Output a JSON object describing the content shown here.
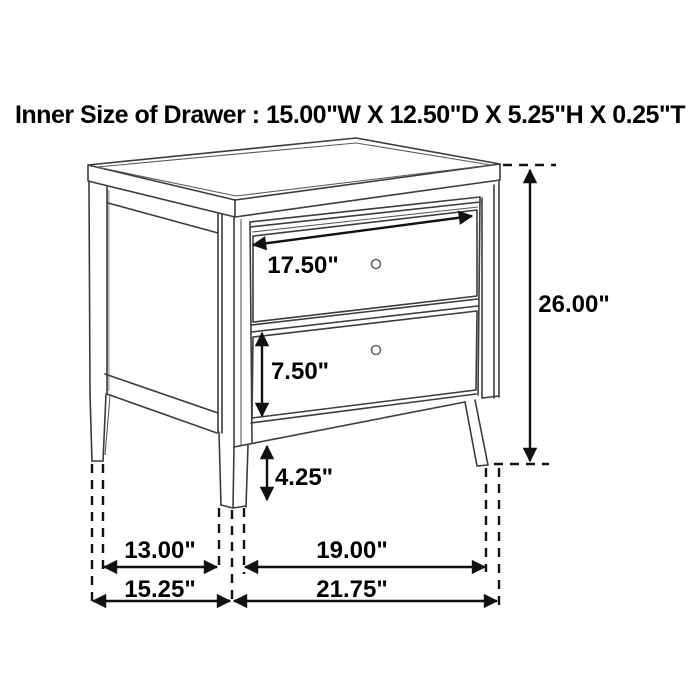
{
  "title": "Inner Size of Drawer : 15.00\"W X 12.50\"D X 5.25\"H X 0.25\"T",
  "dimension_labels": {
    "drawer_width": "17.50\"",
    "drawer_height": "7.50\"",
    "leg_height": "4.25\"",
    "overall_height": "26.00\"",
    "base_inner_side": "13.00\"",
    "base_outer_side": "15.25\"",
    "base_inner_front": "19.00\"",
    "base_outer_front": "21.75\""
  },
  "colors": {
    "background": "#ffffff",
    "furniture_line": "#3c3c3c",
    "dimension_line": "#111111",
    "text": "#000000",
    "shade": "#b8b8b8"
  }
}
